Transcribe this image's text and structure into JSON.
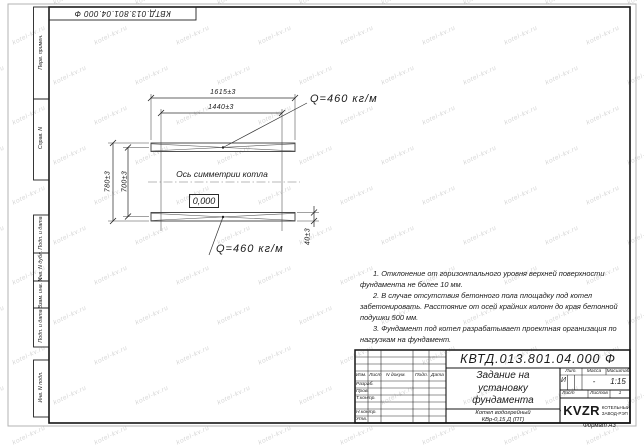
{
  "colors": {
    "line": "#2a2a2a",
    "frame": "#141414",
    "watermark": "#d7d7d7"
  },
  "watermark": {
    "text": "kotel-kv.ru"
  },
  "sheet": {
    "doc_number_top": "КВТД.013.801.04.000 Ф",
    "format_label": "Формат А3"
  },
  "side_labels": {
    "perv_primen": "Перв. примен.",
    "sprav_n": "Справ. N",
    "podp_data_1": "Подп. и дата",
    "inv_dubl": "Инв. N дубл.",
    "vzam_inv": "Взам. инв. N",
    "podp_data_2": "Подп. и дата",
    "inv_podl": "Инв. N подл."
  },
  "drawing": {
    "dim_top_outer": "1615±3",
    "dim_top_inner": "1440±3",
    "dim_left_outer": "780±3",
    "dim_left_inner": "700±3",
    "dim_right": "40±3",
    "load_top": "Q=460 кг/м",
    "load_bottom": "Q=460 кг/м",
    "axis_label": "Ось симметрии котла",
    "level_mark": "0,000"
  },
  "notes": {
    "n1": "1. Отклонение от горизонтального уровня верхней поверхности фундамента не более 10 мм.",
    "n2": "2. В случае отсутствия бетонного пола площадку под котел забетонировать. Расстояние от осей крайних колонн до края бетонной подушки 500 мм.",
    "n3": "3. Фундамент под котел разрабатывает проектная организация по нагрузкам на фундамент."
  },
  "title_block": {
    "doc_number": "КВТД.013.801.04.000 Ф",
    "title": "Задание на\nустановку\nфундамента",
    "product": "Котел водогрейный\nКВр-0,15 Д (ПТ)",
    "header": {
      "izm": "Изм.",
      "list": "Лист",
      "n_doc": "N докум.",
      "podp": "Подп.",
      "data": "Дата"
    },
    "rows": {
      "razrab": "Разраб.",
      "prov": "Пров.",
      "t_contr": "Т.контр.",
      "n_contr": "Н.контр.",
      "utv": "Утв."
    },
    "lit_label": "Лит.",
    "lit_value": "И",
    "massa_label": "Масса",
    "massa_value": "-",
    "masshtab_label": "Масштаб",
    "masshtab_value": "1:15",
    "list_label": "Лист",
    "listov_label": "Листов",
    "listov_value": "1",
    "company_name": "KVZR",
    "company_sub": "КОТЕЛЬНЫЙ\nЗАВОД-РЭП"
  }
}
